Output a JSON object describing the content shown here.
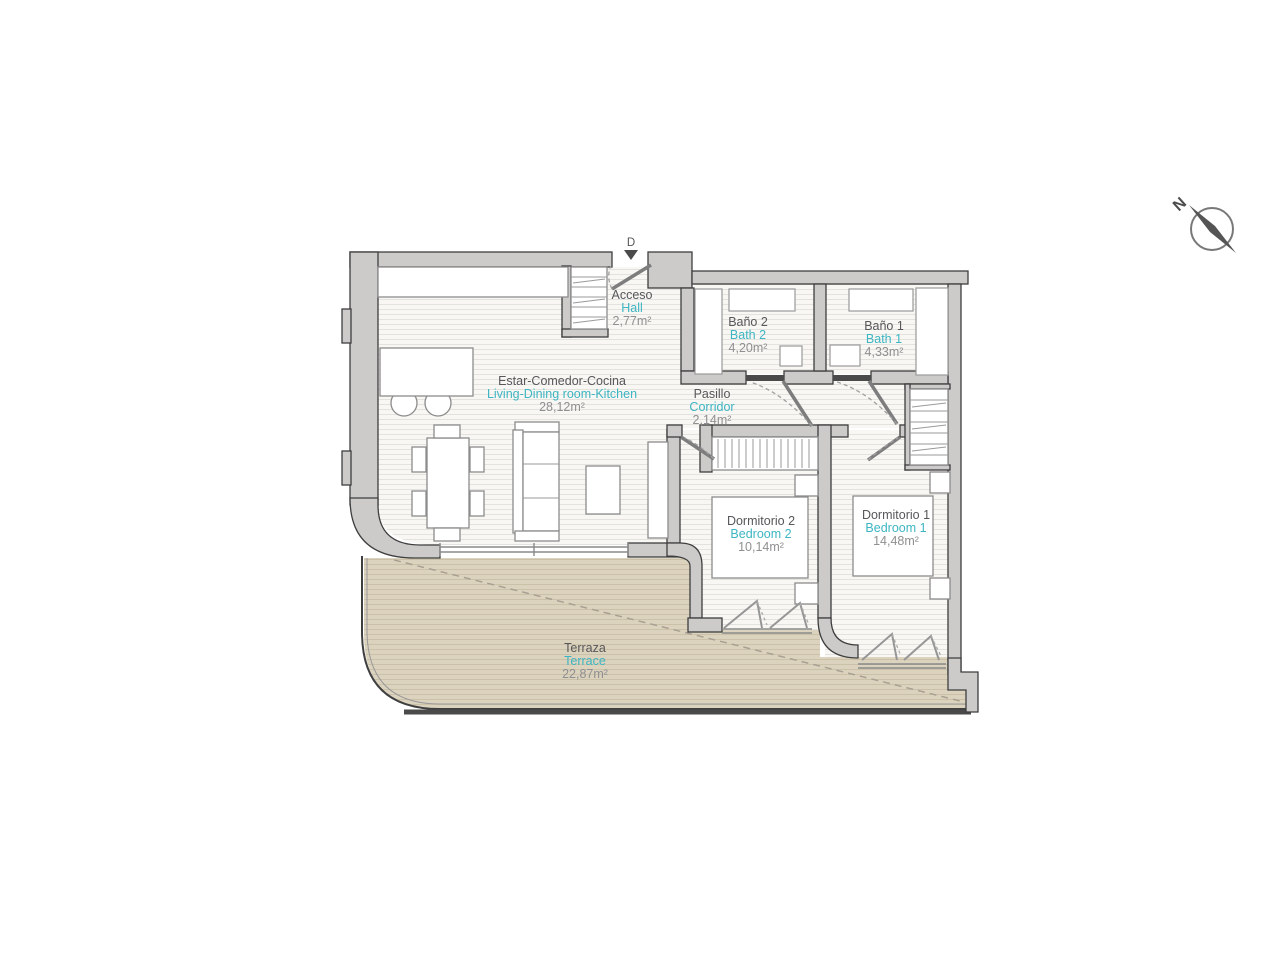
{
  "title": "Apartment floor plan",
  "colors": {
    "accent_teal": "#3db5c2",
    "label_dark": "#57575a",
    "label_gray": "#8f8f91",
    "wall_fill": "#cccbca",
    "terrace_fill": "#dcd3bf",
    "floor_fill": "#f8f7f4"
  },
  "compass": {
    "north_label": "N"
  },
  "entrance": {
    "door_label": "D"
  },
  "rooms": [
    {
      "id": "acceso",
      "name": "Acceso",
      "name_en": "Hall",
      "area": "2,77m²"
    },
    {
      "id": "bano2",
      "name": "Baño 2",
      "name_en": "Bath 2",
      "area": "4,20m²"
    },
    {
      "id": "bano1",
      "name": "Baño 1",
      "name_en": "Bath 1",
      "area": "4,33m²"
    },
    {
      "id": "estar",
      "name": "Estar-Comedor-Cocina",
      "name_en": "Living-Dining room-Kitchen",
      "area": "28,12m²"
    },
    {
      "id": "pasillo",
      "name": "Pasillo",
      "name_en": "Corridor",
      "area": "2,14m²"
    },
    {
      "id": "dormitorio2",
      "name": "Dormitorio 2",
      "name_en": "Bedroom 2",
      "area": "10,14m²"
    },
    {
      "id": "dormitorio1",
      "name": "Dormitorio 1",
      "name_en": "Bedroom 1",
      "area": "14,48m²"
    },
    {
      "id": "terraza",
      "name": "Terraza",
      "name_en": "Terrace",
      "area": "22,87m²"
    }
  ]
}
